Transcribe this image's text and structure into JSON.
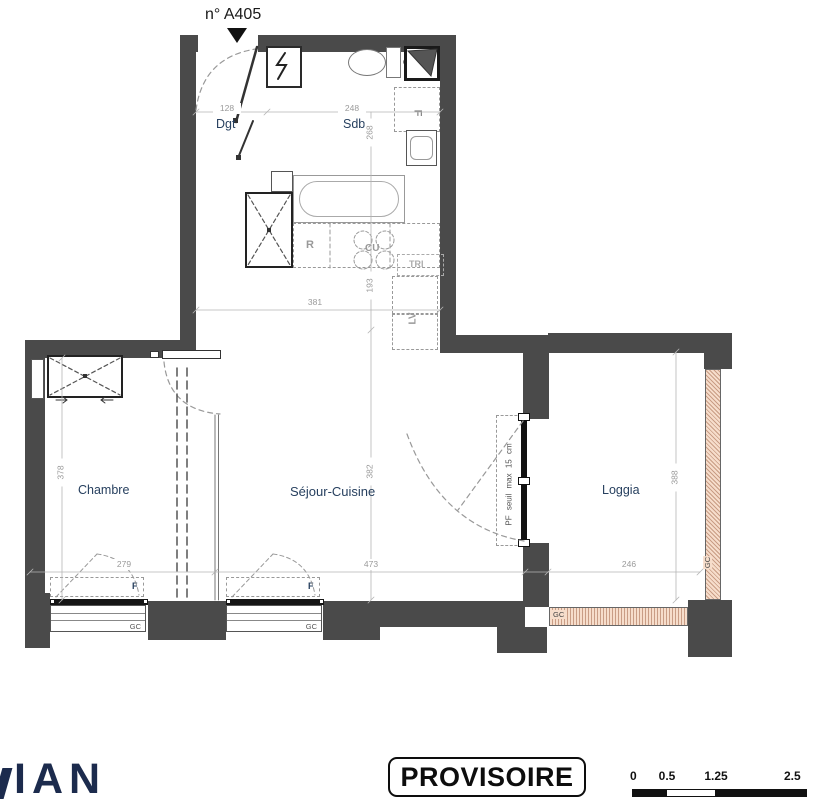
{
  "header": {
    "unit": "n° A405"
  },
  "rooms": {
    "dgt": "Dgt",
    "sdb": "Sdb",
    "chambre": "Chambre",
    "sejour": "Séjour-Cuisine",
    "loggia": "Loggia"
  },
  "dims": {
    "entry_width": "128",
    "sdb_width": "248",
    "sdb_depth": "268",
    "kitchen_depth": "193",
    "upper_width": "381",
    "chambre_depth": "378",
    "sejour_depth": "382",
    "loggia_depth": "388",
    "chambre_width": "279",
    "sejour_width": "473",
    "loggia_width": "246"
  },
  "fixtures": {
    "fridge": "R",
    "hob": "CU",
    "waste_sorting": "TRI",
    "dishwasher": "LV",
    "bath_area": "F"
  },
  "openings": {
    "window": "F",
    "guardrail": "GC",
    "french_window_note": "PF seuil max 15 cm"
  },
  "stamp": {
    "label": "PROVISOIRE"
  },
  "scalebar": {
    "t0": "0",
    "t1": "0.5",
    "t2": "1.25",
    "t3": "2.5"
  },
  "logo": {
    "text": "IAN"
  }
}
